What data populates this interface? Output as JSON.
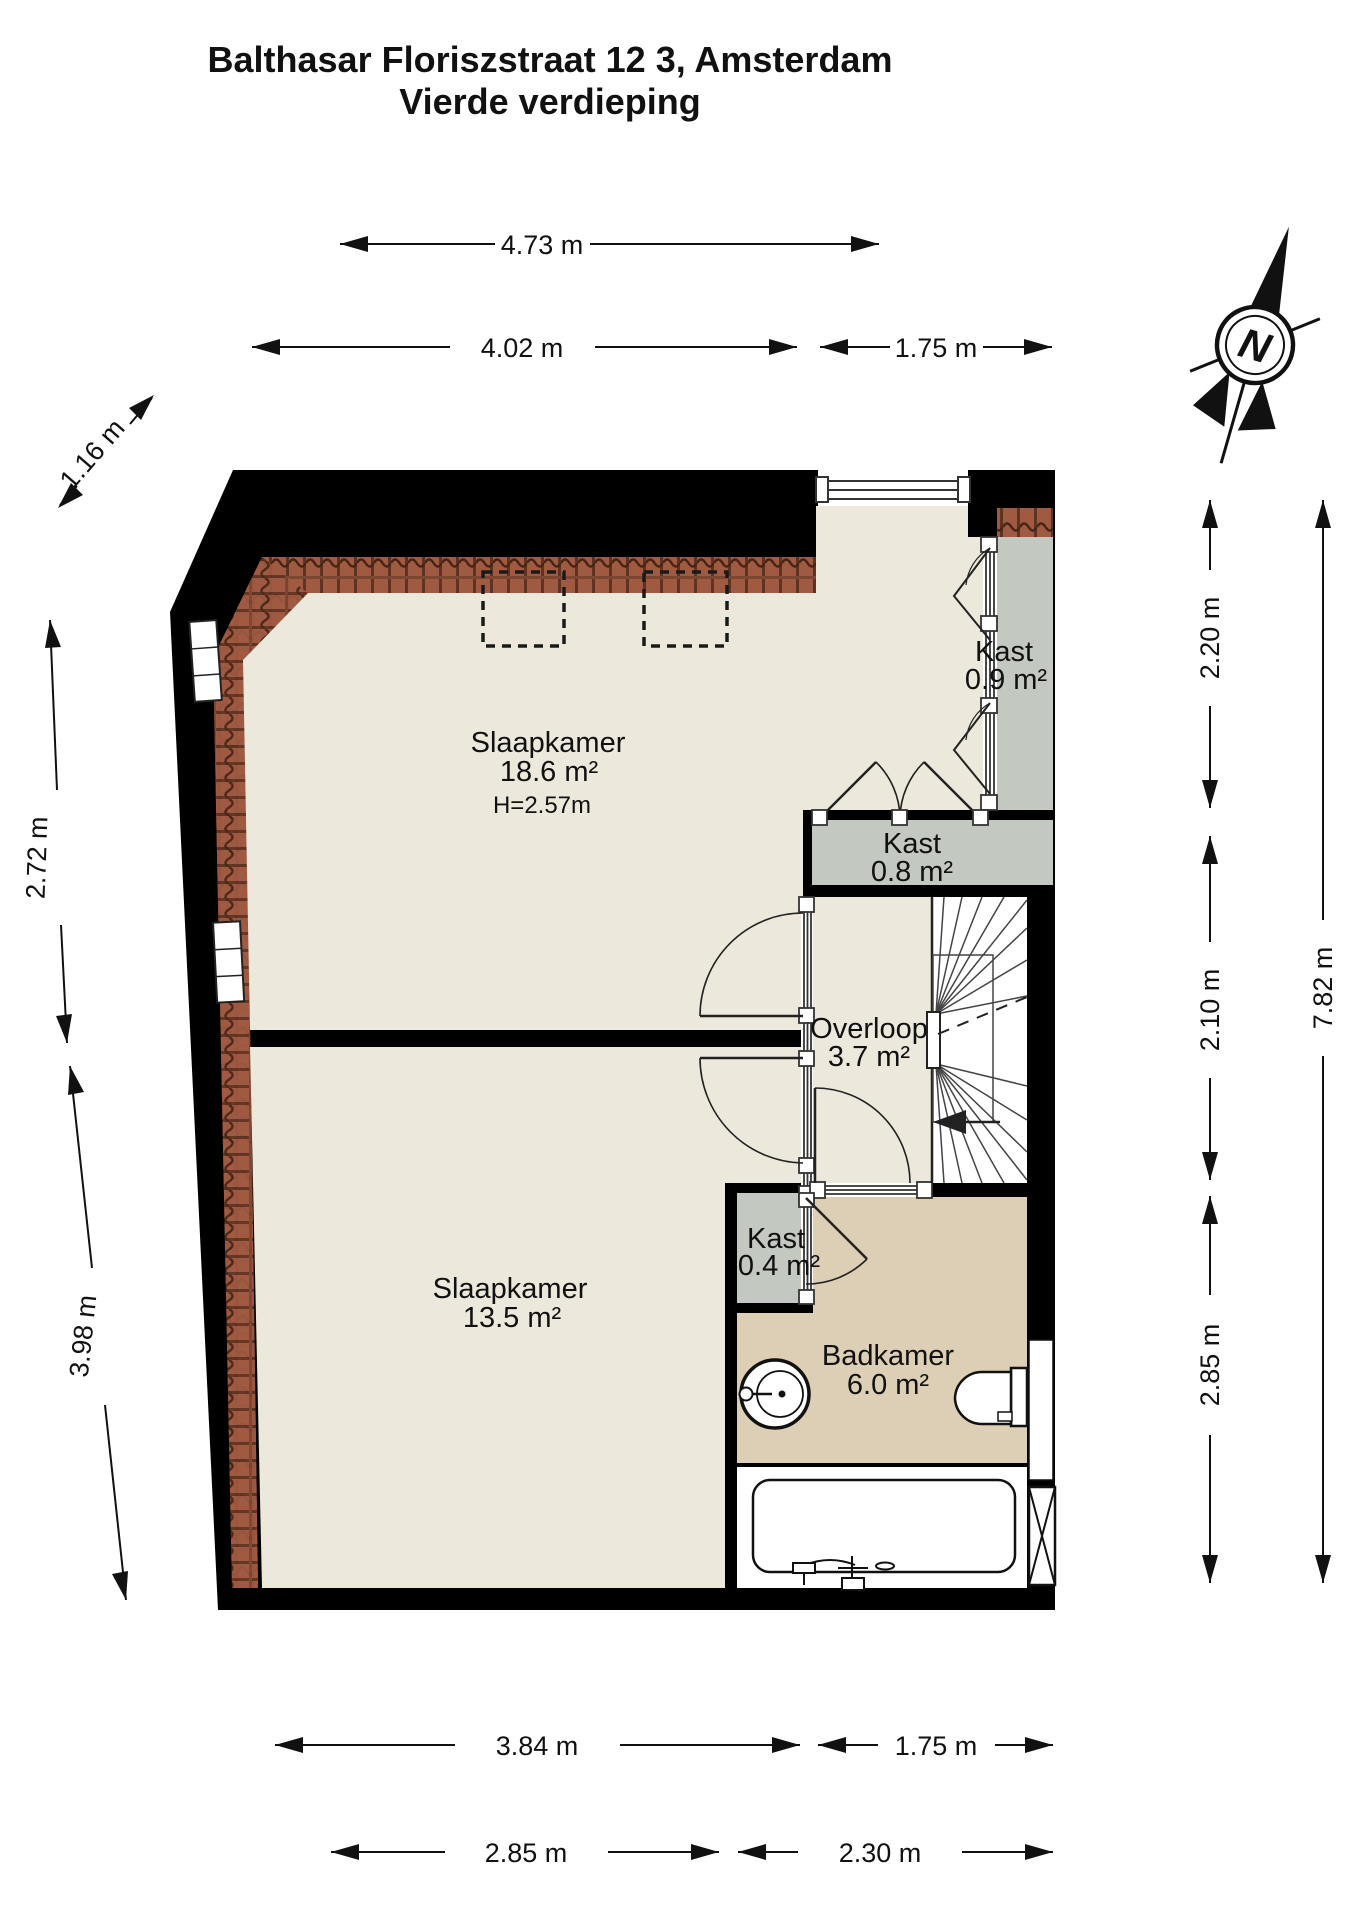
{
  "title": {
    "line1": "Balthasar Floriszstraat 12 3, Amsterdam",
    "line2": "Vierde verdieping"
  },
  "compass": {
    "label": "N"
  },
  "rooms": {
    "slaapkamer1": {
      "name": "Slaapkamer",
      "area": "18.6 m²",
      "ceiling_height": "H=2.57m"
    },
    "slaapkamer2": {
      "name": "Slaapkamer",
      "area": "13.5 m²"
    },
    "overloop": {
      "name": "Overloop",
      "area": "3.7 m²"
    },
    "badkamer": {
      "name": "Badkamer",
      "area": "6.0 m²"
    },
    "kast_09": {
      "name": "Kast",
      "area": "0.9 m²"
    },
    "kast_08": {
      "name": "Kast",
      "area": "0.8 m²"
    },
    "kast_04": {
      "name": "Kast",
      "area": "0.4 m²"
    }
  },
  "dimensions": {
    "top_row1": "4.73 m",
    "top_row2_left": "4.02 m",
    "top_row2_right": "1.75 m",
    "left_diagonal": "1.16 m",
    "left_upper": "2.72 m",
    "left_lower": "3.98 m",
    "right_inner": [
      "2.20 m",
      "2.10 m",
      "2.85 m"
    ],
    "right_outer": "7.82 m",
    "bottom_row1": [
      "3.84 m",
      "1.75 m"
    ],
    "bottom_row2": [
      "2.85 m",
      "2.30 m"
    ]
  },
  "colors": {
    "wall": "#000000",
    "floor": "#ece8db",
    "closet": "#c3c8c0",
    "bathroom_floor": "#ddcfb5",
    "stairs": "#ffffff",
    "roof_tile": "#a05a42",
    "roof_tile_dark": "#5f3322",
    "roof_tile_line": "#46251607"
  }
}
